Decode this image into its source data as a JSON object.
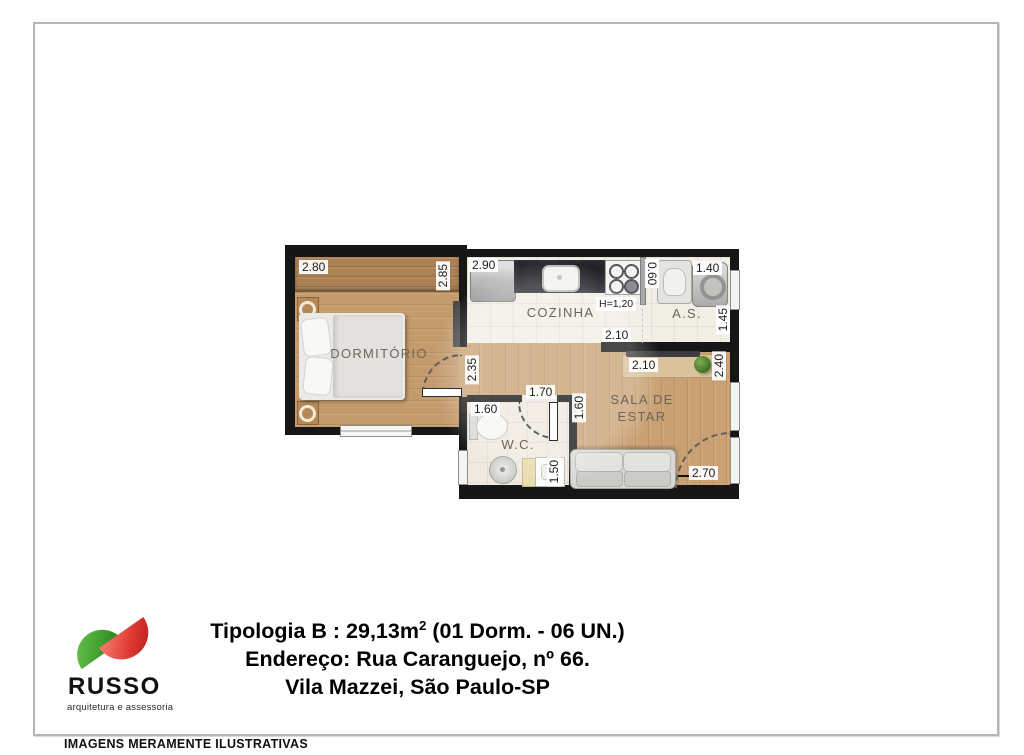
{
  "plan": {
    "rooms": {
      "dormitorio": "DORMITÓRIO",
      "cozinha": "COZINHA",
      "area_servico": "A.S.",
      "sala_line1": "SALA DE",
      "sala_line2": "ESTAR",
      "wc": "W.C."
    },
    "dims": {
      "dorm_width": "2.80",
      "dorm_depth": "2.85",
      "kitchen_entry": "2.90",
      "counter_height": "H=1,20",
      "kitchen_width": "2.10",
      "as_pass": "0.60",
      "as_width": "1.40",
      "as_depth": "1.45",
      "hall_depth": "2.35",
      "hall_width": "1.70",
      "wc_width": "1.60",
      "wc_depth": "1.50",
      "tv_wall": "2.10",
      "sala_depth": "2.40",
      "sala_side": "1.60",
      "sala_width": "2.70"
    }
  },
  "info": {
    "title_pre": "Tipologia B : 29,13m",
    "title_sup": "2",
    "title_post": " (01 Dorm. - 06 UN.)",
    "address": "Endereço: Rua Caranguejo, nº 66.",
    "city": "Vila Mazzei, São Paulo-SP"
  },
  "logo": {
    "name": "RUSSO",
    "tagline": "arquitetura e assessoria",
    "green": "#44a332",
    "red": "#d8211d"
  },
  "footer": {
    "disclaimer": "IMAGENS MERAMENTE ILUSTRATIVAS"
  }
}
